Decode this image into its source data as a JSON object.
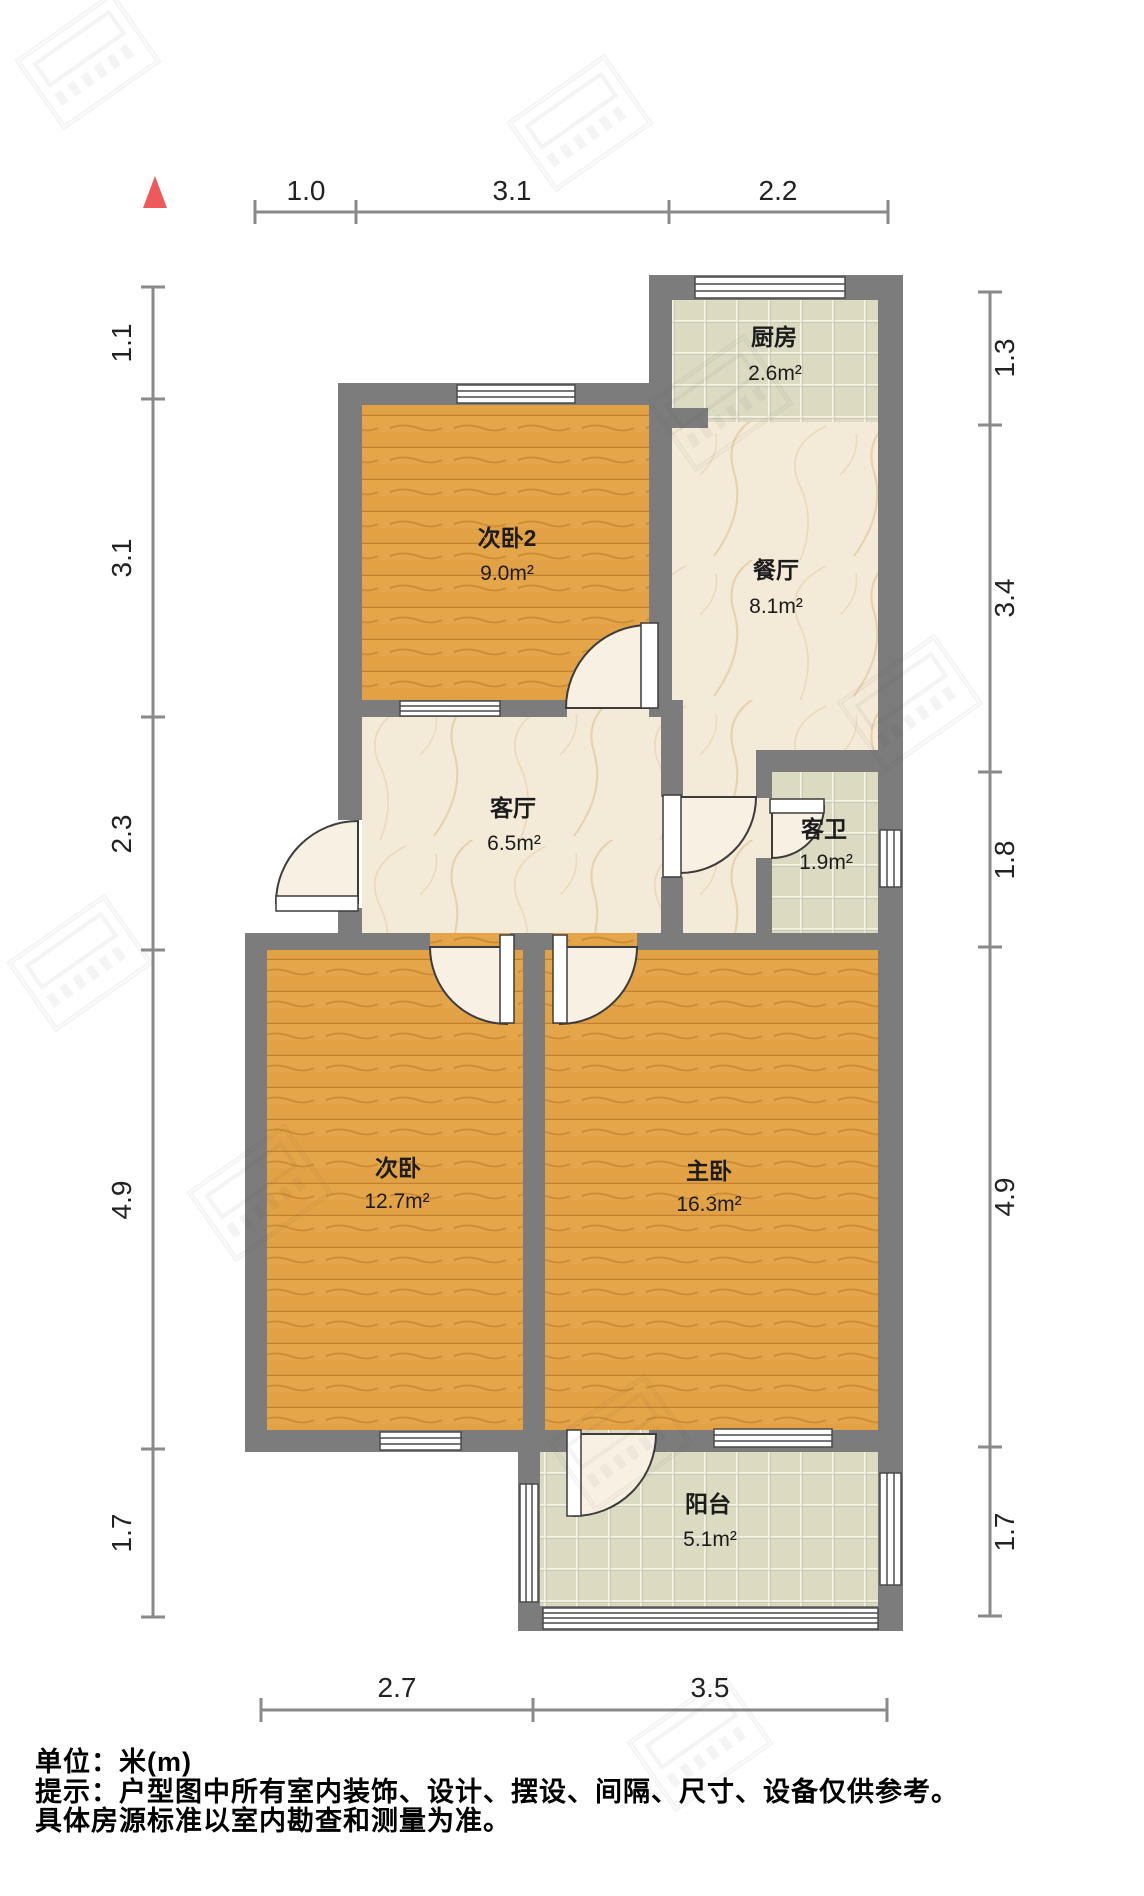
{
  "plan": {
    "rooms": [
      {
        "id": "kitchen",
        "name": "厨房",
        "area": "2.6m²"
      },
      {
        "id": "bedroom2",
        "name": "次卧2",
        "area": "9.0m²"
      },
      {
        "id": "dining",
        "name": "餐厅",
        "area": "8.1m²"
      },
      {
        "id": "living",
        "name": "客厅",
        "area": "6.5m²"
      },
      {
        "id": "bath",
        "name": "客卫",
        "area": "1.9m²"
      },
      {
        "id": "bedroom",
        "name": "次卧",
        "area": "12.7m²"
      },
      {
        "id": "master",
        "name": "主卧",
        "area": "16.3m²"
      },
      {
        "id": "balcony",
        "name": "阳台",
        "area": "5.1m²"
      }
    ],
    "dims": {
      "top": [
        "1.0",
        "3.1",
        "2.2"
      ],
      "bottom": [
        "2.7",
        "3.5"
      ],
      "left": [
        "1.1",
        "3.1",
        "2.3",
        "4.9",
        "1.7"
      ],
      "right": [
        "1.3",
        "3.4",
        "1.8",
        "4.9",
        "1.7"
      ]
    }
  },
  "footer": {
    "unit": "单位：米(m)",
    "tip": "提示：户型图中所有室内装饰、设计、摆设、间隔、尺寸、设备仅供参考。",
    "tip2": "具体房源标准以室内勘查和测量为准。"
  },
  "colors": {
    "wall": "#7c7c7c",
    "wood_floor": "#e2a145",
    "tile_floor": "#dcdac1",
    "marble_floor": "#f3ead7",
    "north_arrow": "#f0595a",
    "dim_line": "#8a8a8a"
  }
}
